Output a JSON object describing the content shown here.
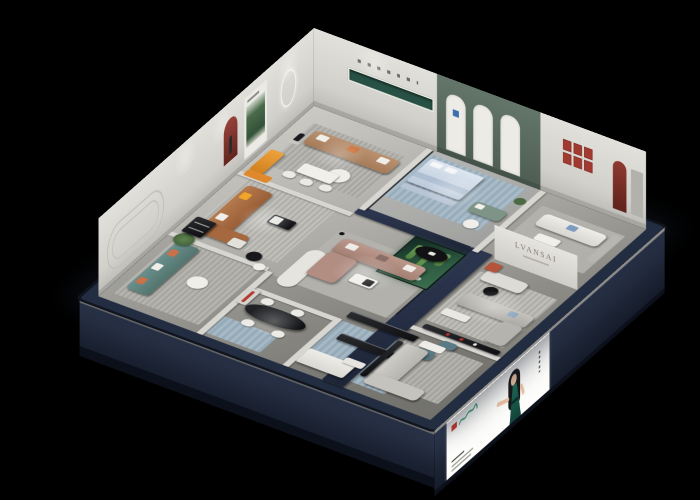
{
  "scene": {
    "description": "Isometric 3D cutaway render of a furniture showroom at night on a black background",
    "background": "#000000"
  },
  "branding": {
    "interior_wall_text": "LVANSAI",
    "banner": {
      "subject": "hostess figure in a green halter dress, long black hair, arm extended",
      "logo_block_color": "#cf3a2e",
      "logo_script_color": "#2fa06a",
      "panel_color": "#fdfdfb"
    }
  },
  "palette": {
    "background": "#000000",
    "outer_wall_top": "#232d41",
    "outer_wall_face": "#1e2637",
    "floor_light": "#cbcac5",
    "floor_dark": "#7f7e78",
    "interior_wall": "#d8d6d1",
    "green_feature_wall": "#5b6b60",
    "green_niche": "#275144",
    "glass_terrarium": "#2f5d43",
    "accent_orange": "#e0892c",
    "accent_red": "#8c362c",
    "sofa_teal": "#5e8280",
    "sofa_brown": "#a5683f",
    "sofa_tan": "#b08663",
    "sofa_mauve": "#b28d82",
    "bed_blue": "#c9d6e4",
    "rug_blue": "#9fb3c2"
  },
  "rooms": [
    {
      "id": "tan-lounge",
      "name": "Tan sofa lounge",
      "items": [
        "tan-sofa",
        "round-coffee-table",
        "dining-table-set",
        "statue",
        "orange-bench",
        "green-wall-niche"
      ]
    },
    {
      "id": "brown-lounge",
      "name": "Brown leather sofa lounge",
      "items": [
        "brown-leather-sofa",
        "coffee-table",
        "red-arch-niche",
        "forest-poster"
      ]
    },
    {
      "id": "teal-lounge",
      "name": "Teal sofa lounge",
      "items": [
        "teal-sofa",
        "round-table",
        "plant",
        "grooved-wall-panel"
      ]
    },
    {
      "id": "bedroom",
      "name": "Bedroom display with arched wall",
      "items": [
        "blue-bed",
        "foot-bench",
        "sage-sofa",
        "side-table",
        "arched-wall-panels"
      ]
    },
    {
      "id": "corner-suite",
      "name": "White corner suite",
      "items": [
        "white-sofa",
        "coffee-table",
        "red-frame-grid",
        "red-arch-niche"
      ]
    },
    {
      "id": "media-lounge",
      "name": "Gray media lounge",
      "items": [
        "brand-wall",
        "gray-corner-sofa",
        "white-sofa",
        "media-console",
        "white-bench",
        "accent-chair",
        "black-round-table"
      ]
    },
    {
      "id": "terrarium",
      "name": "Glass cactus terrarium",
      "items": [
        "cacti",
        "pebbles"
      ]
    },
    {
      "id": "center-lounge",
      "name": "Mauve corner sofa lounge",
      "items": [
        "mauve-corner-sofa",
        "coffee-table",
        "black-oval-table",
        "curved-partition",
        "floor-lamp"
      ]
    },
    {
      "id": "dining",
      "name": "Dining display",
      "items": [
        "black-oval-dining-table",
        "white-chairs",
        "display-shelf",
        "red-accent"
      ]
    },
    {
      "id": "front-gallery",
      "name": "Front console gallery",
      "items": [
        "black-console",
        "black-console-2",
        "white-modular-sofa",
        "teal-ottomans",
        "blue-rug"
      ]
    },
    {
      "id": "front-right-lounge",
      "name": "Front right lounge",
      "items": [
        "gray-sofa-set",
        "white-ottoman",
        "tv-console"
      ]
    }
  ]
}
